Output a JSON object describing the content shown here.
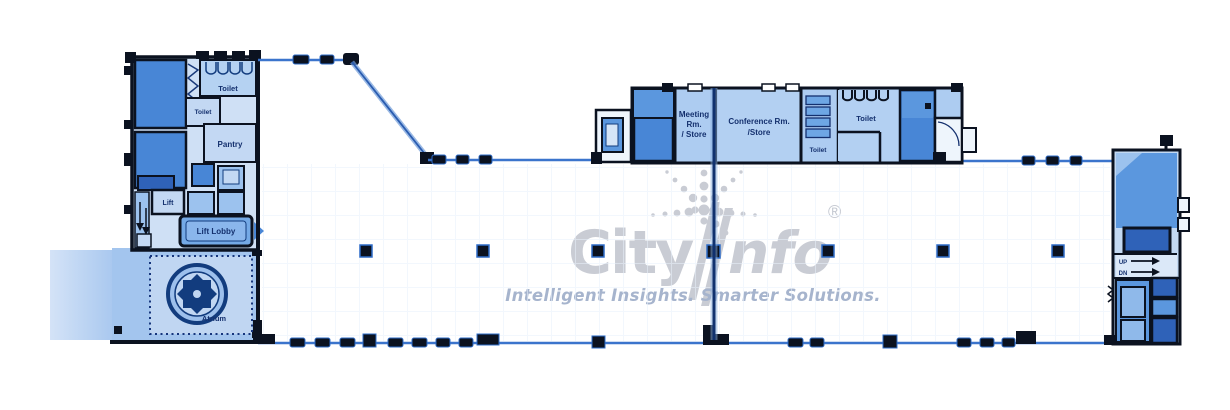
{
  "watermark": {
    "brand_city": "City",
    "brand_info": "nfo",
    "registered": "®",
    "tagline": "Intelligent Insights. Smarter Solutions."
  },
  "labels": {
    "toilet_nw": "Toilet",
    "toilet_nw_small": "Toilet",
    "pantry": "Pantry",
    "lift_west": "Lift",
    "lift_lobby": "Lift Lobby",
    "atrium": "Atrium",
    "meeting_l1": "Meeting",
    "meeting_l2": "Rm.",
    "meeting_l3": "/ Store",
    "conference_l1": "Conference Rm.",
    "conference_l2": "/Store",
    "toilet_mid_small": "Toilet",
    "toilet_mid": "Toilet",
    "up": "UP",
    "dn": "DN"
  },
  "colors": {
    "wall_black": "#0b1220",
    "line_blue": "#3b74cc",
    "room_dark": "#4886d6",
    "room_darker": "#2f62b8",
    "room_medium": "#5b97de",
    "room_light": "#adccf1",
    "room_lighter": "#c3d8f3",
    "atrium_fill": "#a3c5ee",
    "label_navy": "#14306e",
    "watermark_grey": "#c9ccd4",
    "tagline_grey_blue": "#a6b4cd"
  }
}
